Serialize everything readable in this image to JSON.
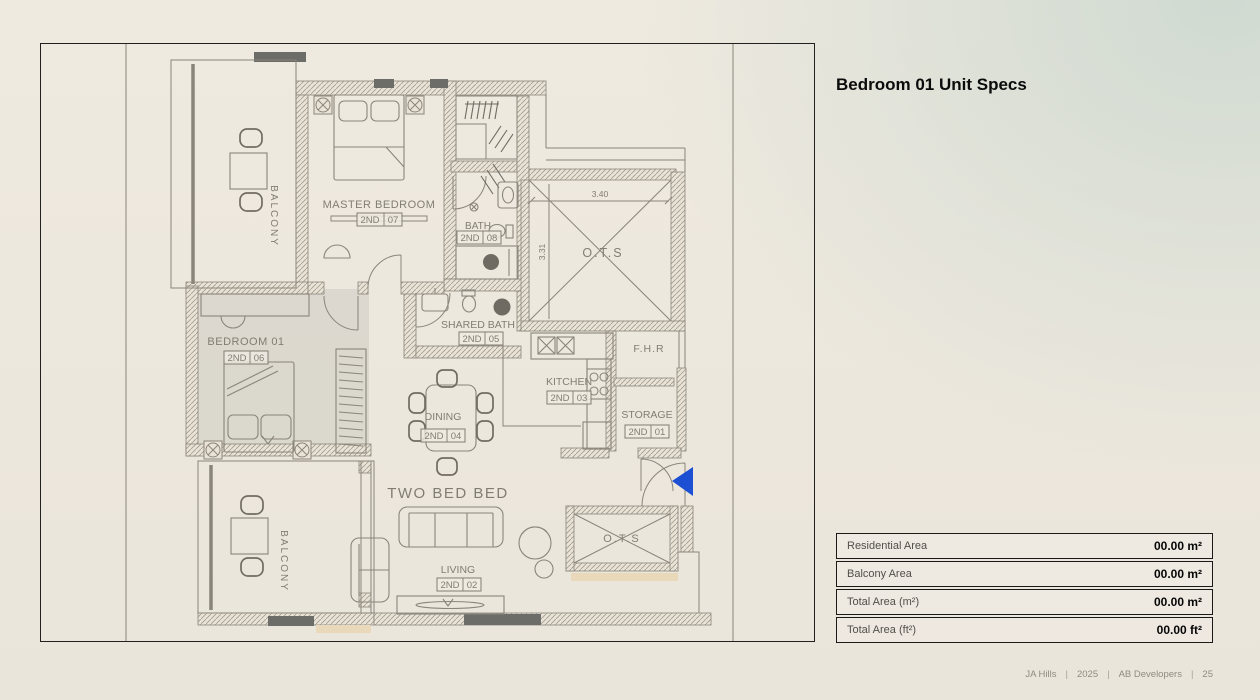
{
  "specs_panel": {
    "title": "Bedroom 01 Unit Specs",
    "table": {
      "rows": [
        {
          "label": "Residential Area",
          "value": "00.00 m²"
        },
        {
          "label": "Balcony Area",
          "value": "00.00 m²"
        },
        {
          "label": "Total Area (m²)",
          "value": "00.00 m²"
        },
        {
          "label": "Total Area (ft²)",
          "value": "00.00 ft²"
        }
      ]
    }
  },
  "footer": {
    "separator": "|",
    "items": [
      "JA Hills",
      "2025",
      "AB Developers",
      "25"
    ]
  },
  "floor_plan": {
    "unit_label": "TWO BED BED",
    "rooms": {
      "master_bedroom": {
        "name": "MASTER BEDROOM",
        "tag_prefix": "2ND",
        "tag_num": "07"
      },
      "bedroom_01": {
        "name": "BEDROOM 01",
        "tag_prefix": "2ND",
        "tag_num": "06"
      },
      "bath": {
        "name": "BATH",
        "tag_prefix": "2ND",
        "tag_num": "08"
      },
      "shared_bath": {
        "name": "SHARED BATH",
        "tag_prefix": "2ND",
        "tag_num": "05"
      },
      "dining": {
        "name": "DINING",
        "tag_prefix": "2ND",
        "tag_num": "04"
      },
      "kitchen": {
        "name": "KITCHEN",
        "tag_prefix": "2ND",
        "tag_num": "03"
      },
      "living": {
        "name": "LIVING",
        "tag_prefix": "2ND",
        "tag_num": "02"
      },
      "storage": {
        "name": "STORAGE",
        "tag_prefix": "2ND",
        "tag_num": "01"
      },
      "balcony_top": "BALCONY",
      "balcony_bottom": "BALCONY",
      "ots_top": "O.T.S",
      "ots_bottom": "O.T.S",
      "fhr": "F.H.R"
    },
    "dimensions": {
      "ots_width_m": "3.40",
      "ots_height_m": "3.31"
    },
    "markers": {
      "entrance_arrow_color": "#1d4fd2"
    }
  }
}
